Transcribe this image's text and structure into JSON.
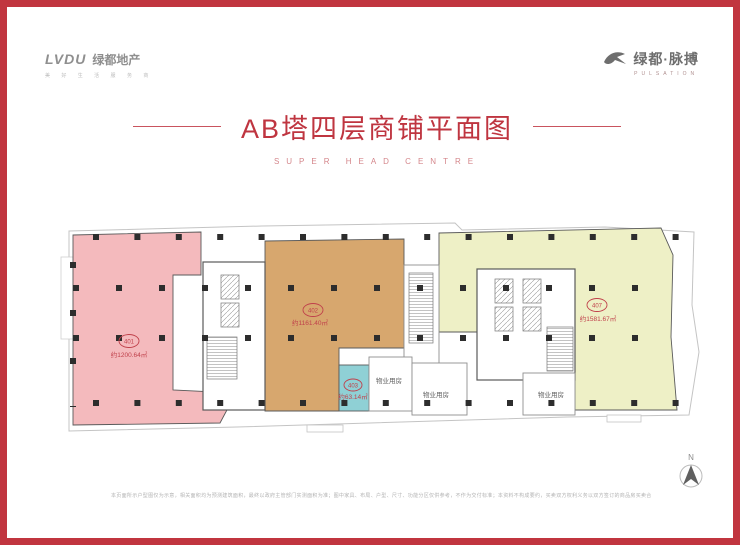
{
  "colors": {
    "frame_red": "#c1353f",
    "title_red": "#bf3540",
    "subtitle_pink": "#d4868b",
    "unit_401_pink": "#f4babd",
    "unit_402_tan": "#d7a76e",
    "unit_403_teal": "#8fd0d5",
    "unit_407_yellow": "#eef0c6",
    "wall_dark": "#2d2d2d"
  },
  "icons": {
    "logo_bird": "bird-icon",
    "compass": "north-arrow-icon"
  },
  "header": {
    "logo_left": {
      "latin": "LVDU",
      "cn": "绿都地产",
      "tagline": "美 好 生 活 服 务 商"
    },
    "logo_right": {
      "cn": "绿都·脉搏",
      "en": "PULSATION"
    },
    "title": "AB塔四层商铺平面图",
    "subtitle": "SUPER HEAD CENTRE"
  },
  "plan": {
    "units": [
      {
        "no": "401",
        "area": "约1200.64㎡",
        "color": "#f4babd"
      },
      {
        "no": "402",
        "area": "约1161.40㎡",
        "color": "#d7a76e"
      },
      {
        "no": "403",
        "area": "约63.14㎡",
        "color": "#8fd0d5"
      },
      {
        "no": "407",
        "area": "约1581.67㎡",
        "color": "#eef0c6"
      }
    ],
    "property_rooms": [
      "物业用房",
      "物业用房",
      "物业用房"
    ],
    "compass_label": "N"
  },
  "footer": {
    "disclaimer": "本页面所示户型图仅为示意，相关面积均为预测建筑面积，最终以政府主管部门实测面积为准；图中家具、布局、户型、尺寸、功能分区仅供参考，不作为交付标准；本资料不构成要约，买卖双方权利义务以双方签订的商品房买卖合同及附件为准。"
  }
}
